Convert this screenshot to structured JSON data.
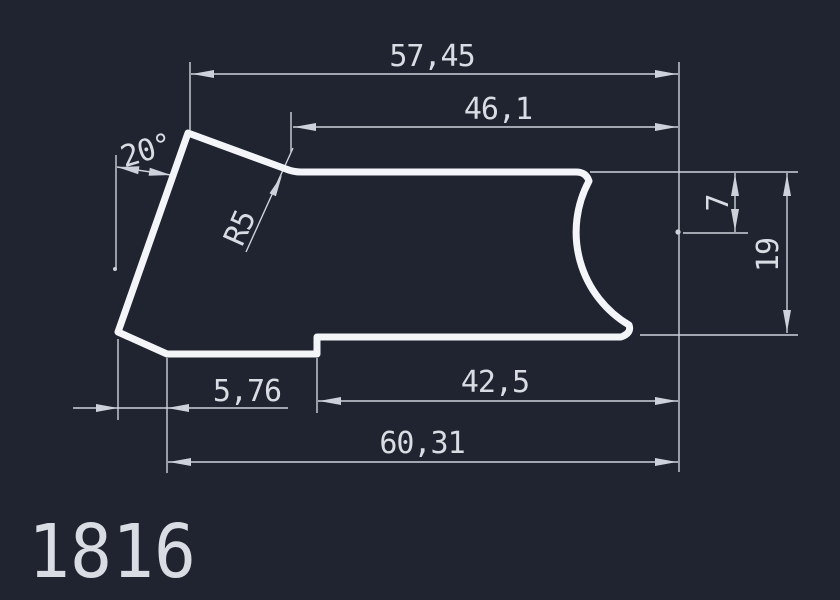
{
  "drawing": {
    "part_number": "1816",
    "background_color": "#1f2430",
    "dimension_color": "#cdd2da",
    "text_color": "#d9dde3",
    "outline_color": "#f3f5f8"
  },
  "dimensions": {
    "top_width": "57,45",
    "top_edge_width": "46,1",
    "left_angle": "20°",
    "fillet_radius": "R5",
    "arc_center_depth": "7",
    "right_height": "19",
    "bottom_left_offset": "5,76",
    "bottom_edge_width": "42,5",
    "bottom_width": "60,31"
  }
}
